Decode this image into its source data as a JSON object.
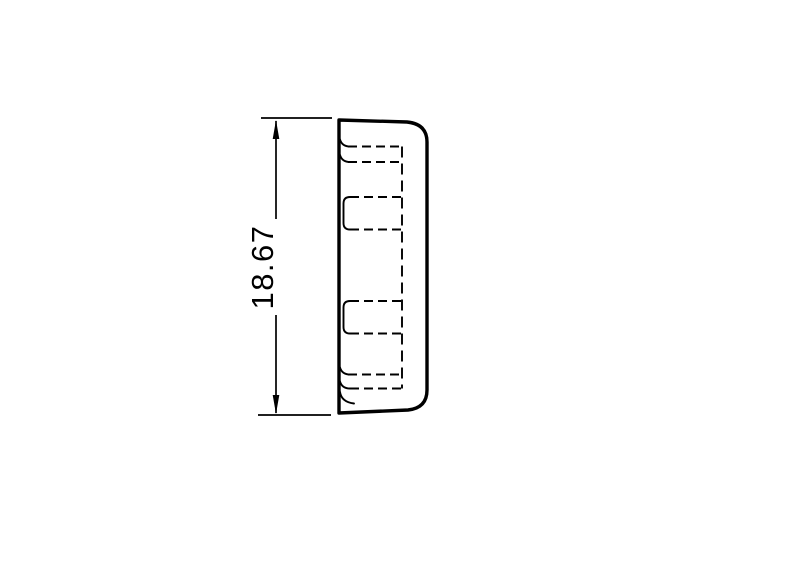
{
  "drawing": {
    "title": "cap-side-profile-technical-drawing",
    "dimension": {
      "label": "18.67"
    }
  },
  "colors": {
    "line": "#000000",
    "background": "#ffffff"
  }
}
